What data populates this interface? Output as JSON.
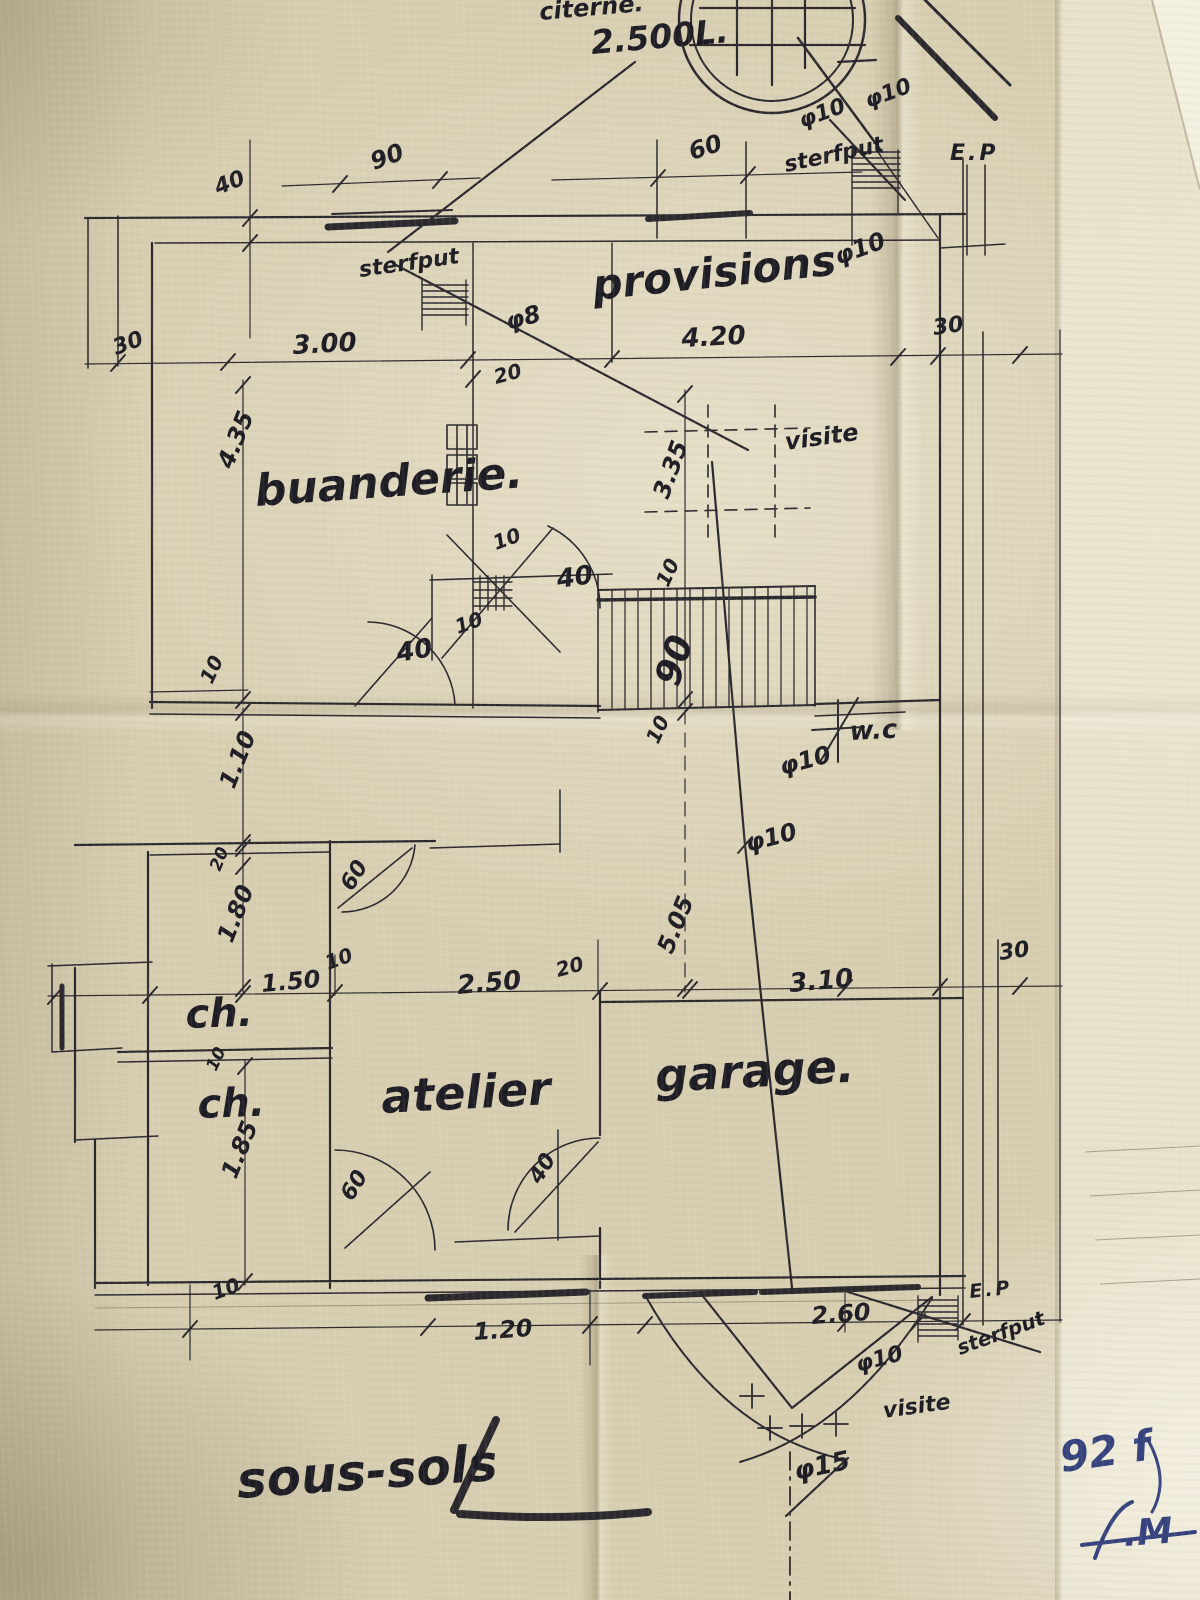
{
  "colors": {
    "ink": "#1d1c24",
    "blue": "#35427d",
    "paper": "#d8cfb2"
  },
  "rooms": {
    "citerne": "citerne.",
    "citerne_capacity": "2.500L.",
    "provisions": "provisions",
    "buanderie": "buanderie.",
    "atelier": "atelier",
    "garage": "garage.",
    "ch_upper": "ch.",
    "ch_lower": "ch.",
    "wc": "w.c",
    "title": "sous-sols"
  },
  "drains": {
    "ep_top": "E.P",
    "ep_bottom": "E.P",
    "sterfput_top": "sterfput",
    "sterfput_mid": "sterfput",
    "sterfput_bottom": "sterfput",
    "visite_top": "visite",
    "visite_bottom": "visite",
    "phi10_top_a": "φ10",
    "phi10_top_b": "φ10",
    "phi10_top_c": "φ10",
    "phi8": "φ8",
    "phi10_mid_a": "φ10",
    "phi10_mid_b": "φ10",
    "phi10_bottom": "φ10",
    "phi15": "φ15"
  },
  "dims": {
    "d60_top": "60",
    "d40_topleft": "40",
    "d90_window": "90",
    "d30_left": "30",
    "d300": "3.00",
    "d420": "4.20",
    "d30_topright": "30",
    "d20_top": "20",
    "d435": "4.35",
    "d335": "3.35",
    "d10_a": "10",
    "d40_door_a": "40",
    "d10_b": "10",
    "d40_door_b": "40",
    "d10_c": "10",
    "d90_stairs": "90",
    "d10_d": "10",
    "d10_h": "10",
    "d110": "1.10",
    "d20_left": "20",
    "d60_door_a": "60",
    "d180": "1.80",
    "d150": "1.50",
    "d10_e": "10",
    "d250": "2.50",
    "d20_mid": "20",
    "d505": "5.05",
    "d310": "3.10",
    "d30_botright": "30",
    "d10_f": "10",
    "d185": "1.85",
    "d60_door_b": "60",
    "d40_door_c": "40",
    "d10_g": "10",
    "d120": "1.20",
    "d260": "2.60"
  },
  "notes": {
    "number": "92 f",
    "signature": ".M"
  }
}
